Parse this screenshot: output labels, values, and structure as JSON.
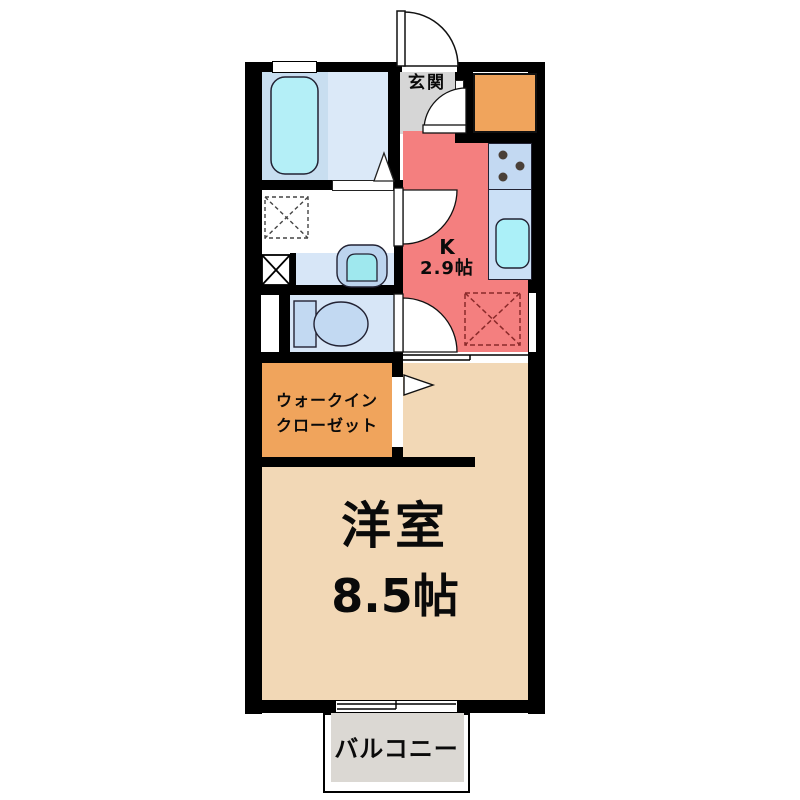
{
  "figure": "apartment-floorplan",
  "palette": {
    "wall": "#000000",
    "bath_floor": "#c8def0",
    "bath_floor_light": "#dbe9f8",
    "bathtub": "#b4eff7",
    "washroom_floor": "#ffffff",
    "vanity_and_toilet_floor": "#d7e6f7",
    "entrance_floor": "#d6d6d6",
    "kitchen_floor": "#f47f7f",
    "counter_stove": "#c3d9f2",
    "counter_sink": "#cbe0f6",
    "kitchen_sink": "#abf0f8",
    "storage_and_closet": "#f0a45c",
    "western_room_floor": "#f2d8b6",
    "balcony_floor": "#dbd8d3",
    "refrigerator_outline": "#8a2a2a"
  },
  "labels": {
    "entrance": "玄関",
    "kitchen_line1": "K",
    "kitchen_line2": "2.9帖",
    "closet_line1": "ウォークイン",
    "closet_line2": "クローゼット",
    "room_line1": "洋室",
    "room_line2": "8.5帖",
    "balcony": "バルコニー"
  },
  "fixtures": [
    "bathtub",
    "bath-window",
    "bath-folding-door",
    "washing-machine-pan",
    "pipe-space",
    "washbasin",
    "toilet",
    "toilet-window",
    "entrance-door",
    "hall-door",
    "washroom-door",
    "toilet-door",
    "kitchen-stove",
    "kitchen-sink",
    "refrigerator-space",
    "kitchen-window",
    "closet-door",
    "sliding-door",
    "balcony-window"
  ]
}
